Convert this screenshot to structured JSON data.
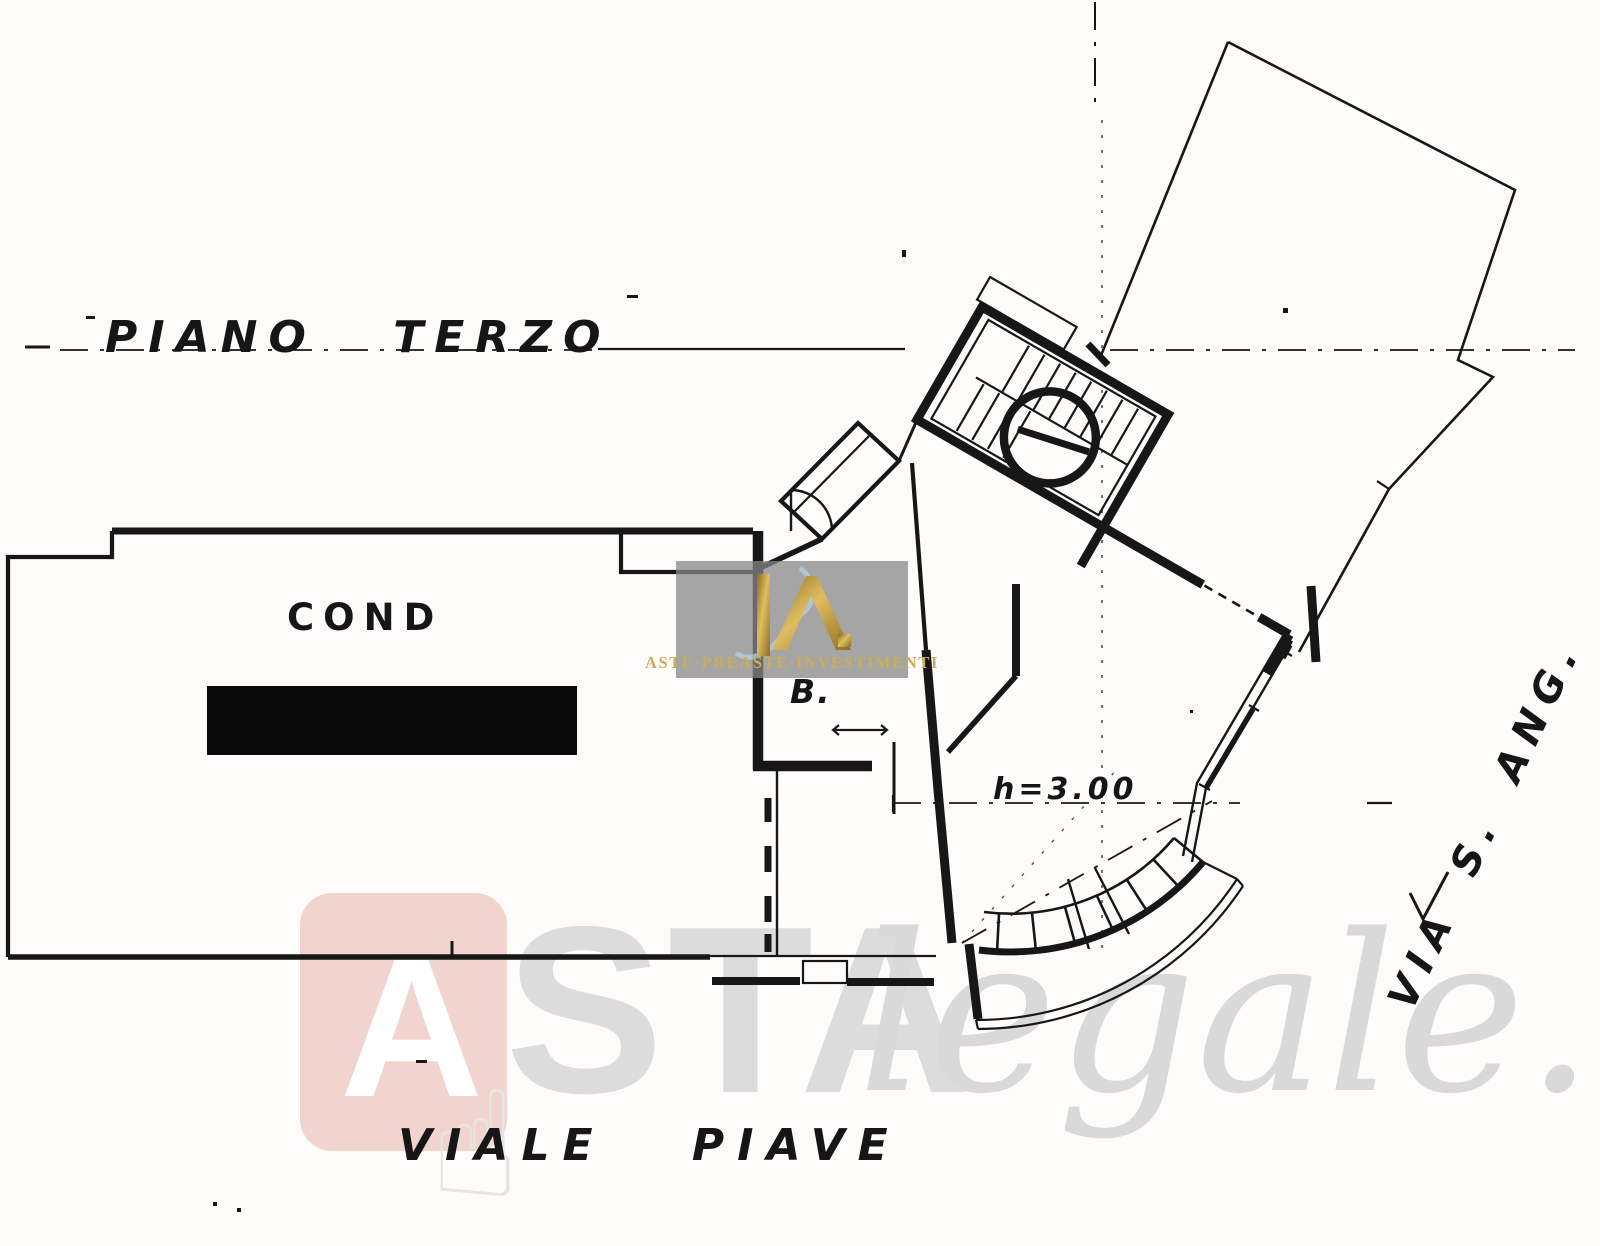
{
  "page": {
    "background": "#fdfcfa",
    "ink": "#171717"
  },
  "plan": {
    "title": "PIANO TERZO",
    "labels": {
      "condominio": "COND",
      "room_b": "B.",
      "ceiling_height": "h=3.00"
    },
    "streets": {
      "bottom": "VIALE PIAVE",
      "right": "VIA S. ANG."
    },
    "features": {
      "redaction": "black-redaction-bar",
      "stairwell": "stair-flight-with-circular-shaft",
      "balcony": "segmented-curved-balcony"
    }
  },
  "watermarks": {
    "astalegale": {
      "logo_letter": "A",
      "wordmark_bold": "STA",
      "wordmark_script": "legale.net",
      "hand_icon": "pointing-hand",
      "logo_box_color": "#f1d4ce",
      "text_color": "#dadada"
    },
    "agency": {
      "monogram": "R",
      "caption": "ASTE·PREASTE·INVESTIMENTI",
      "panel_color": "#878787",
      "gold_color": "#c9a551"
    }
  }
}
